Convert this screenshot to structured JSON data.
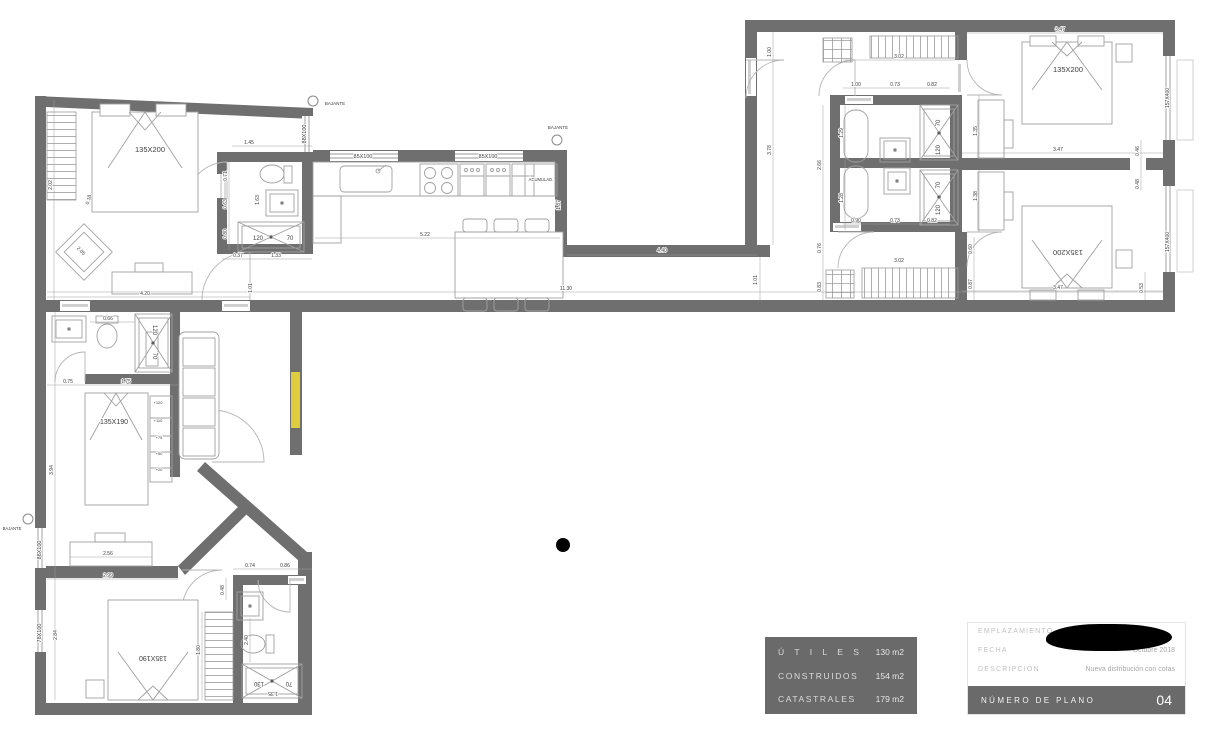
{
  "colors": {
    "wall": "#6f6f6f",
    "furniture": "#9c9c9c",
    "dim_line": "#9a9a9a",
    "highlight": "#e6d23c",
    "panel": "#6a6a6a"
  },
  "areas_table": {
    "rows": [
      {
        "label": "Ú T I L E S",
        "value": "130 m2"
      },
      {
        "label": "CONSTRUIDOS",
        "value": "154 m2"
      },
      {
        "label": "CATASTRALES",
        "value": "179 m2"
      }
    ]
  },
  "title_block": {
    "emplazamiento_label": "EMPLAZAMIENTO",
    "fecha_label": "FECHA",
    "fecha_value": "Octubre 2018",
    "descripcion_label": "DESCRIPCIÓN",
    "descripcion_value": "Nueva distribución con cotas",
    "numero_label": "NÚMERO DE PLANO",
    "numero_value": "04"
  },
  "plan": {
    "dim_labels": [
      {
        "t": "1.45",
        "x": 249,
        "y": 144
      },
      {
        "t": "0.71",
        "x": 227,
        "y": 176,
        "r": -90
      },
      {
        "t": "0.63",
        "x": 227,
        "y": 204,
        "r": -90
      },
      {
        "t": "0.80",
        "x": 227,
        "y": 234,
        "r": -90
      },
      {
        "t": "1.63",
        "x": 259,
        "y": 200,
        "r": -90
      },
      {
        "t": "0.37",
        "x": 238,
        "y": 257
      },
      {
        "t": "1.33",
        "x": 276,
        "y": 257
      },
      {
        "t": "1.01",
        "x": 252,
        "y": 288,
        "r": -90
      },
      {
        "t": "2.02",
        "x": 52,
        "y": 185,
        "r": -90
      },
      {
        "t": "0.18",
        "x": 90,
        "y": 200,
        "r": -75
      },
      {
        "t": "2.05",
        "x": 80,
        "y": 252,
        "r": 45
      },
      {
        "t": "4.20",
        "x": 145,
        "y": 295
      },
      {
        "t": "5.22",
        "x": 425,
        "y": 236
      },
      {
        "t": "1.87",
        "x": 560,
        "y": 205,
        "r": -90
      },
      {
        "t": "4.40",
        "x": 662,
        "y": 252
      },
      {
        "t": "3.78",
        "x": 771,
        "y": 150,
        "r": -90
      },
      {
        "t": "1.00",
        "x": 771,
        "y": 52,
        "r": -90
      },
      {
        "t": "1.01",
        "x": 757,
        "y": 280,
        "r": -90
      },
      {
        "t": "11.30",
        "x": 566,
        "y": 290
      },
      {
        "t": "0.76",
        "x": 821,
        "y": 248,
        "r": -90
      },
      {
        "t": "0.83",
        "x": 821,
        "y": 287,
        "r": -90
      },
      {
        "t": "2.66",
        "x": 821,
        "y": 165,
        "r": -90
      },
      {
        "t": "3.02",
        "x": 899,
        "y": 58
      },
      {
        "t": "1.00",
        "x": 856,
        "y": 86
      },
      {
        "t": "0.73",
        "x": 895,
        "y": 86
      },
      {
        "t": "0.82",
        "x": 932,
        "y": 86
      },
      {
        "t": "1.29",
        "x": 843,
        "y": 133,
        "r": -90
      },
      {
        "t": "1.28",
        "x": 843,
        "y": 198,
        "r": -90
      },
      {
        "t": "0.90",
        "x": 856,
        "y": 222
      },
      {
        "t": "0.73",
        "x": 895,
        "y": 222
      },
      {
        "t": "0.82",
        "x": 932,
        "y": 222
      },
      {
        "t": "3.02",
        "x": 899,
        "y": 262
      },
      {
        "t": "1.35",
        "x": 977,
        "y": 131,
        "r": -90
      },
      {
        "t": "1.38",
        "x": 977,
        "y": 196,
        "r": -90
      },
      {
        "t": "0.60",
        "x": 972,
        "y": 249,
        "r": -90
      },
      {
        "t": "0.87",
        "x": 972,
        "y": 284,
        "r": -90
      },
      {
        "t": "3.47",
        "x": 1060,
        "y": 31
      },
      {
        "t": "3.47",
        "x": 1058,
        "y": 151
      },
      {
        "t": "3.47",
        "x": 1058,
        "y": 289
      },
      {
        "t": "0.46",
        "x": 1139,
        "y": 151,
        "r": -90
      },
      {
        "t": "0.48",
        "x": 1139,
        "y": 184,
        "r": -90
      },
      {
        "t": "0.53",
        "x": 1143,
        "y": 288,
        "r": -90
      },
      {
        "t": "0.66",
        "x": 108,
        "y": 320
      },
      {
        "t": "0.75",
        "x": 68,
        "y": 383
      },
      {
        "t": "1.75",
        "x": 126,
        "y": 383
      },
      {
        "t": "3.94",
        "x": 53,
        "y": 470,
        "r": -90
      },
      {
        "t": "2.56",
        "x": 108,
        "y": 555
      },
      {
        "t": "2.99",
        "x": 108,
        "y": 577
      },
      {
        "t": "2.84",
        "x": 57,
        "y": 635,
        "r": -90
      },
      {
        "t": "1.80",
        "x": 200,
        "y": 650,
        "r": -90
      },
      {
        "t": "0.74",
        "x": 250,
        "y": 567
      },
      {
        "t": "0.86",
        "x": 285,
        "y": 567
      },
      {
        "t": "0.48",
        "x": 224,
        "y": 590,
        "r": -90
      },
      {
        "t": "2.40",
        "x": 248,
        "y": 640,
        "r": -90
      },
      {
        "t": "1.35",
        "x": 273,
        "y": 692,
        "r": 180
      }
    ],
    "feature_labels": [
      {
        "t": "135X200",
        "x": 150,
        "y": 152,
        "s": 7.5,
        "c": "#5f5f5f",
        "n": "bed-size-label"
      },
      {
        "t": "135X200",
        "x": 1068,
        "y": 72,
        "s": 7.5,
        "c": "#5f5f5f",
        "n": "bed-size-label"
      },
      {
        "t": "135X200",
        "x": 1068,
        "y": 250,
        "s": 7.5,
        "c": "#5f5f5f",
        "r": 180,
        "n": "bed-size-label"
      },
      {
        "t": "135X190",
        "x": 114,
        "y": 424,
        "s": 7,
        "c": "#5f5f5f",
        "n": "bed-size-label"
      },
      {
        "t": "135X190",
        "x": 153,
        "y": 656,
        "s": 7,
        "c": "#5f5f5f",
        "r": 180,
        "n": "bed-size-label"
      },
      {
        "t": "120",
        "x": 258,
        "y": 240,
        "s": 6,
        "n": "shower-size-label"
      },
      {
        "t": "70",
        "x": 290,
        "y": 240,
        "s": 6,
        "n": "shower-size-label"
      },
      {
        "t": "120",
        "x": 153,
        "y": 330,
        "s": 6,
        "r": 90,
        "n": "shower-size-label"
      },
      {
        "t": "70",
        "x": 153,
        "y": 356,
        "s": 6,
        "r": 90,
        "n": "shower-size-label"
      },
      {
        "t": "70",
        "x": 940,
        "y": 123,
        "s": 6,
        "r": -90,
        "n": "shower-size-label"
      },
      {
        "t": "120",
        "x": 940,
        "y": 150,
        "s": 6,
        "r": -90,
        "n": "shower-size-label"
      },
      {
        "t": "70",
        "x": 940,
        "y": 185,
        "s": 6,
        "r": -90,
        "n": "shower-size-label"
      },
      {
        "t": "120",
        "x": 940,
        "y": 210,
        "s": 6,
        "r": -90,
        "n": "shower-size-label"
      },
      {
        "t": "130",
        "x": 259,
        "y": 682,
        "s": 6,
        "r": 180,
        "n": "shower-size-label"
      },
      {
        "t": "70",
        "x": 289,
        "y": 682,
        "s": 6,
        "r": 180,
        "n": "shower-size-label"
      },
      {
        "t": "88X100",
        "x": 306,
        "y": 134,
        "s": 5.5,
        "r": -90,
        "n": "window-size-label"
      },
      {
        "t": "85X100",
        "x": 363,
        "y": 158,
        "s": 5.5,
        "n": "window-size-label"
      },
      {
        "t": "85X100",
        "x": 488,
        "y": 158,
        "s": 5.5,
        "n": "window-size-label"
      },
      {
        "t": "157X400",
        "x": 1169,
        "y": 98,
        "s": 5,
        "r": -90,
        "n": "window-size-label"
      },
      {
        "t": "157X400",
        "x": 1169,
        "y": 242,
        "s": 5,
        "r": -90,
        "n": "window-size-label"
      },
      {
        "t": "88X100",
        "x": 41,
        "y": 550,
        "s": 5.5,
        "r": -90,
        "n": "window-size-label"
      },
      {
        "t": "78X100",
        "x": 41,
        "y": 633,
        "s": 5.5,
        "r": -90,
        "n": "window-size-label"
      },
      {
        "t": "BAJANTE",
        "x": 335,
        "y": 105,
        "s": 4.5,
        "c": "#9a9a9a",
        "n": "bajante-label"
      },
      {
        "t": "BAJANTE",
        "x": 558,
        "y": 129,
        "s": 4.5,
        "c": "#9a9a9a",
        "n": "bajante-label"
      },
      {
        "t": "BAJANTE",
        "x": 12,
        "y": 530,
        "s": 4.2,
        "c": "#9a9a9a",
        "n": "bajante-label"
      },
      {
        "t": "ACUMULAD.",
        "x": 541,
        "y": 181,
        "s": 4.2,
        "c": "#6a6a6a",
        "n": "acumulador-label"
      },
      {
        "t": "+120",
        "x": 158,
        "y": 404,
        "s": 4,
        "c": "#a8a8a8",
        "n": "shelf-height-label"
      },
      {
        "t": "+110",
        "x": 158,
        "y": 422,
        "s": 4,
        "c": "#a8a8a8",
        "n": "shelf-height-label"
      },
      {
        "t": "+75",
        "x": 159,
        "y": 439,
        "s": 4,
        "c": "#a8a8a8",
        "n": "shelf-height-label"
      },
      {
        "t": "+50",
        "x": 159,
        "y": 455,
        "s": 4,
        "c": "#a8a8a8",
        "n": "shelf-height-label"
      },
      {
        "t": "+20",
        "x": 159,
        "y": 471,
        "s": 4,
        "c": "#a8a8a8",
        "n": "shelf-height-label"
      }
    ]
  }
}
